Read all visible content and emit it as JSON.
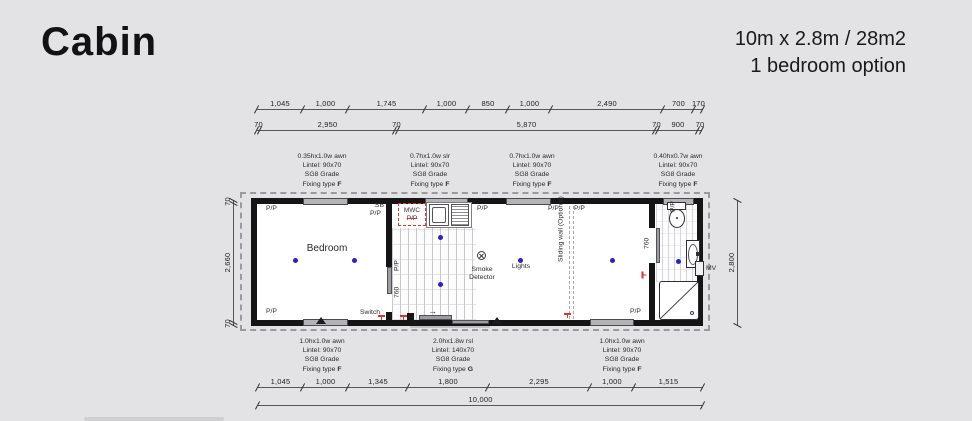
{
  "header": {
    "title": "Cabin",
    "subtitle1": "10m x 2.8m / 28m2",
    "subtitle2": "1 bedroom option"
  },
  "dims": {
    "top1": [
      "1,045",
      "1,000",
      "1,745",
      "1,000",
      "850",
      "1,000",
      "2,490",
      "700",
      "170"
    ],
    "top2": [
      "70",
      "2,950",
      "70",
      "5,870",
      "70",
      "900",
      "70"
    ],
    "bot1": [
      "1,045",
      "1,000",
      "1,345",
      "1,800",
      "2,295",
      "1,000",
      "1,515"
    ],
    "total": "10,000",
    "left": [
      "70",
      "2,660",
      "70"
    ],
    "right": "2,800"
  },
  "specs_top": [
    {
      "size": "0.35hx1.0w awn",
      "lintel": "Lintel: 90x70",
      "grade": "SG8 Grade",
      "fix": "Fixing type",
      "type": "F"
    },
    {
      "size": "0.7hx1.0w slr",
      "lintel": "Lintel: 90x70",
      "grade": "SG8 Grade",
      "fix": "Fixing type",
      "type": "F"
    },
    {
      "size": "0.7hx1.0w awn",
      "lintel": "Lintel: 90x70",
      "grade": "SG8 Grade",
      "fix": "Fixing type",
      "type": "F"
    },
    {
      "size": "0.40hx0.7w awn",
      "lintel": "Lintel: 90x70",
      "grade": "SG8 Grade",
      "fix": "Fixing type",
      "type": "F"
    }
  ],
  "specs_bottom": [
    {
      "size": "1.0hx1.0w awn",
      "lintel": "Lintel: 90x70",
      "grade": "SG8 Grade",
      "fix": "Fixing type",
      "type": "F"
    },
    {
      "size": "2.0hx1.8w rsl",
      "lintel": "Lintel: 140x70",
      "grade": "SG8 Grade",
      "fix": "Fixing type",
      "type": "G"
    },
    {
      "size": "1.0hx1.0w awn",
      "lintel": "Lintel: 90x70",
      "grade": "SG8 Grade",
      "fix": "Fixing type",
      "type": "F"
    }
  ],
  "plan": {
    "bedroom": "Bedroom",
    "lights": "Lights",
    "smoke1": "Smoke",
    "smoke2": "Detector",
    "switch": "Switch",
    "sliding": "Sliding wall (Optional)",
    "mwc": "MWC",
    "pp": "P/P",
    "sb": "SB",
    "mv": "MV",
    "door760": "760",
    "arrow": "→"
  },
  "colors": {
    "background": "#e3e3e5",
    "wall": "#151515",
    "light_dot": "#2222cf",
    "marker_red": "#e23324",
    "window_gray": "#b3b3b7"
  }
}
